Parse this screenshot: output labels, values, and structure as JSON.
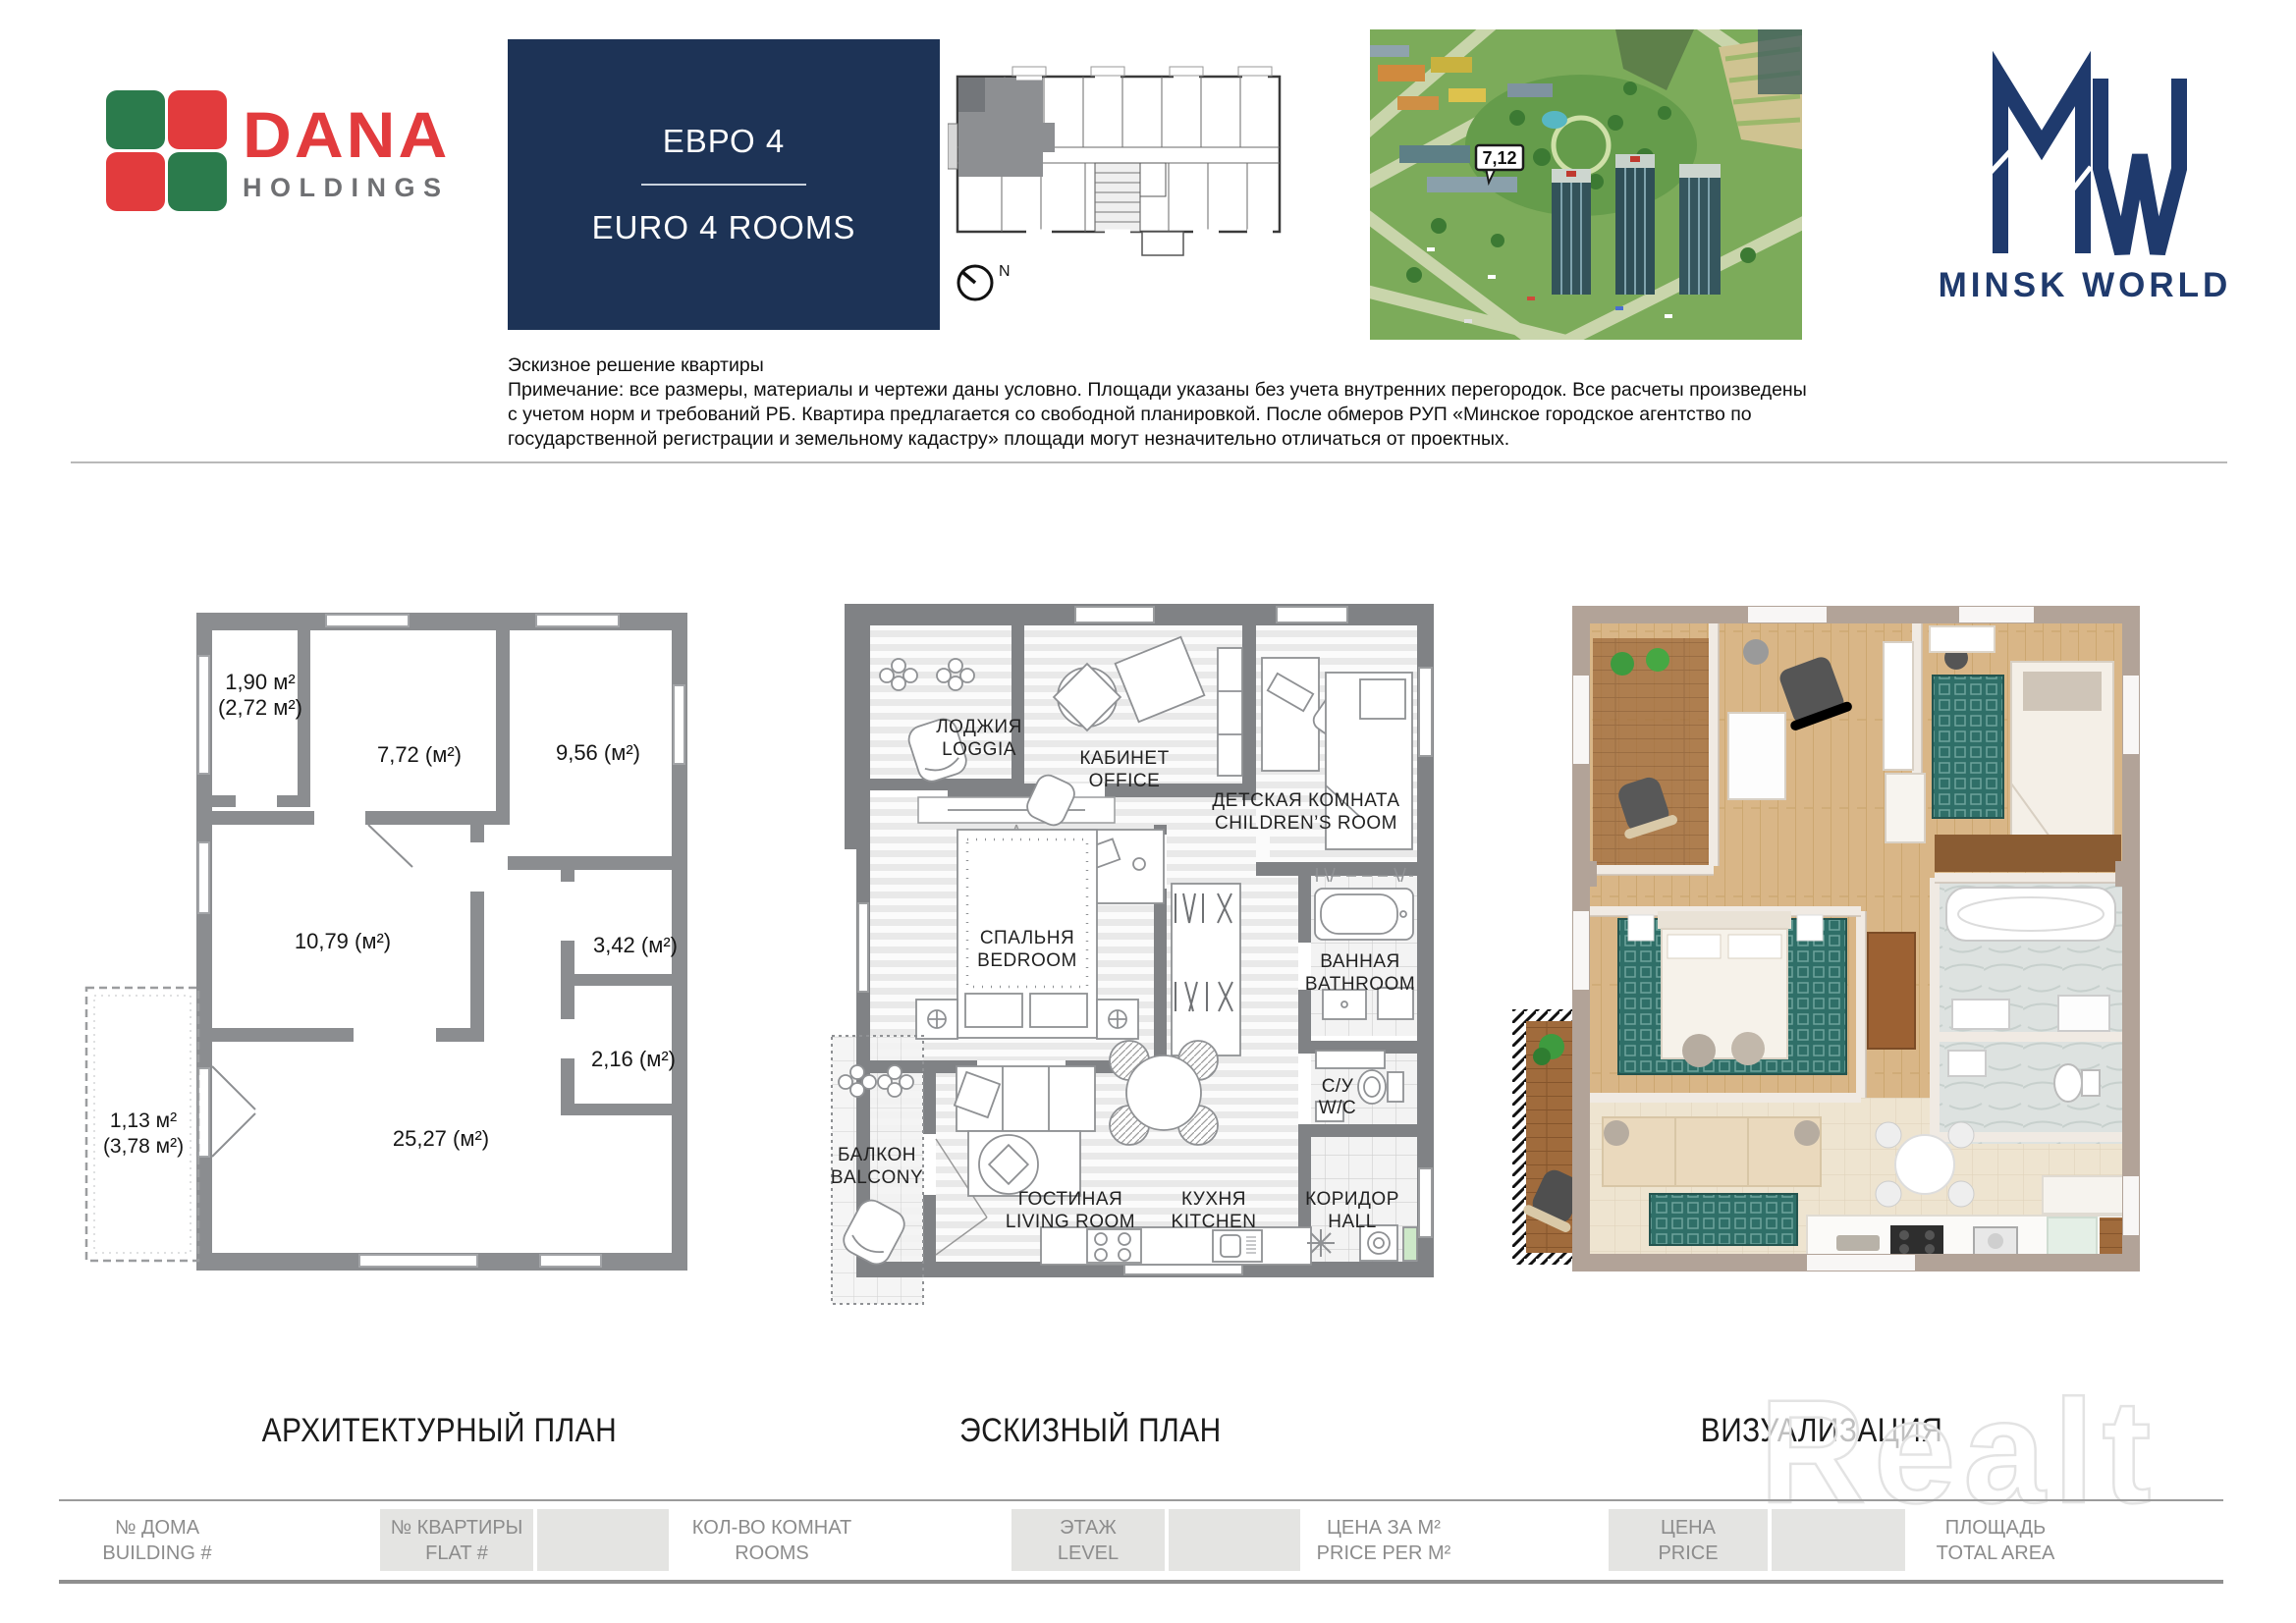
{
  "header": {
    "dana": {
      "brand": "DANA",
      "sub": "HOLDINGS"
    },
    "unit_box": {
      "title_ru": "ЕВРО 4",
      "title_en": "EURO 4 ROOMS"
    },
    "mini_plan": {
      "compass_label": "N"
    },
    "aerial": {
      "site_label": "7,12"
    },
    "minsk_world": {
      "brand": "MINSK WORLD"
    }
  },
  "disclaimer": {
    "line1": "Эскизное решение квартиры",
    "line2": "Примечание: все размеры, материалы и чертежи даны условно. Площади указаны без учета внутренних перегородок. Все расчеты произведены",
    "line3": "с учетом норм и требований РБ. Квартира предлагается со свободной планировкой. После обмеров РУП «Минское городское агентство по",
    "line4": "государственной регистрации и земельному кадастру» площади могут незначительно отличаться от проектных."
  },
  "architectural_plan": {
    "title": "АРХИТЕКТУРНЫЙ ПЛАН",
    "areas": {
      "loggia_1": "1,90 м²",
      "loggia_2": "(2,72 м²)",
      "office": "7,72 (м²)",
      "children": "9,56 (м²)",
      "bedroom": "10,79 (м²)",
      "bathroom": "3,42 (м²)",
      "wc": "2,16 (м²)",
      "balcony_1": "1,13 м²",
      "balcony_2": "(3,78 м²)",
      "living": "25,27 (м²)"
    }
  },
  "sketch_plan": {
    "title": "ЭСКИЗНЫЙ ПЛАН",
    "rooms": {
      "loggia_ru": "ЛОДЖИЯ",
      "loggia_en": "LOGGIA",
      "office_ru": "КАБИНЕТ",
      "office_en": "OFFICE",
      "children_ru": "ДЕТСКАЯ КОМНАТА",
      "children_en": "CHILDREN’S ROOM",
      "bedroom_ru": "СПАЛЬНЯ",
      "bedroom_en": "BEDROOM",
      "bathroom_ru": "ВАННАЯ",
      "bathroom_en": "BATHROOM",
      "wc_ru": "С/У",
      "wc_en": "W/C",
      "balcony_ru": "БАЛКОН",
      "balcony_en": "BALCONY",
      "living_ru": "ГОСТИНАЯ",
      "living_en": "LIVING ROOM",
      "kitchen_ru": "КУХНЯ",
      "kitchen_en": "KITCHEN",
      "hall_ru": "КОРИДОР",
      "hall_en": "HALL"
    }
  },
  "visualization": {
    "title": "ВИЗУАЛИЗАЦИЯ",
    "watermark": "Realt"
  },
  "footer": {
    "building_ru": "№ ДОМА",
    "building_en": "BUILDING #",
    "flat_ru": "№ КВАРТИРЫ",
    "flat_en": "FLAT #",
    "rooms_ru": "КОЛ-ВО КОМНАТ",
    "rooms_en": "ROOMS",
    "level_ru": "ЭТАЖ",
    "level_en": "LEVEL",
    "price_m2_ru": "ЦЕНА ЗА М²",
    "price_m2_en": "PRICE PER M²",
    "price_ru": "ЦЕНА",
    "price_en": "PRICE",
    "area_ru": "ПЛОЩАДЬ",
    "area_en": "TOTAL AREA"
  },
  "colors": {
    "navy_box": "#1d3356",
    "brand_navy": "#1f3a6d",
    "dana_red": "#e23b3d",
    "dana_green": "#2b7b4c",
    "holdings_gray": "#6f7073",
    "arch_wall_gray": "#8b8d90",
    "sketch_wall_gray": "#808285",
    "footer_box": "#e4e4e2",
    "footer_text": "#8c8c8c",
    "teal_rug": "#2f6f68",
    "wood": "#d8b585"
  }
}
